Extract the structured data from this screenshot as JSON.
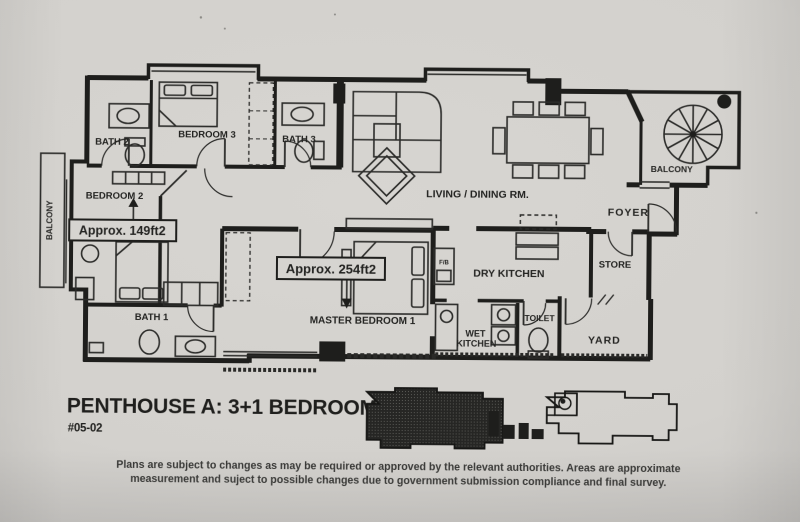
{
  "plan": {
    "rooms": {
      "bath2": "BATH 2",
      "bedroom3": "BEDROOM 3",
      "bath3": "BATH 3",
      "bedroom2": "BEDROOM 2",
      "balcony_left": "BALCONY",
      "living_dining": "LIVING / DINING RM.",
      "balcony_right": "BALCONY",
      "foyer": "FOYER",
      "store": "STORE",
      "master_bedroom1": "MASTER BEDROOM 1",
      "dry_kitchen": "DRY KITCHEN",
      "wet_kitchen_line1": "WET",
      "wet_kitchen_line2": "KITCHEN",
      "toilet": "TOILET",
      "yard": "YARD",
      "bath1": "BATH 1",
      "utility_duct": "F/B"
    },
    "area_labels": {
      "bedroom2": "Approx. 149ft2",
      "master_bedroom": "Approx. 254ft2"
    },
    "title": "PENTHOUSE A: 3+1 BEDROOM",
    "unit_no": "#05-02",
    "disclaimer": {
      "line1": "Plans are subject to changes as may be required or approved by the relevant authorities. Areas are approximate",
      "line2": "measurement and suject to possible changes due to government submission compliance and final survey."
    },
    "colors": {
      "paper": "#d3d1cd",
      "ink": "#1e1e1c"
    }
  }
}
